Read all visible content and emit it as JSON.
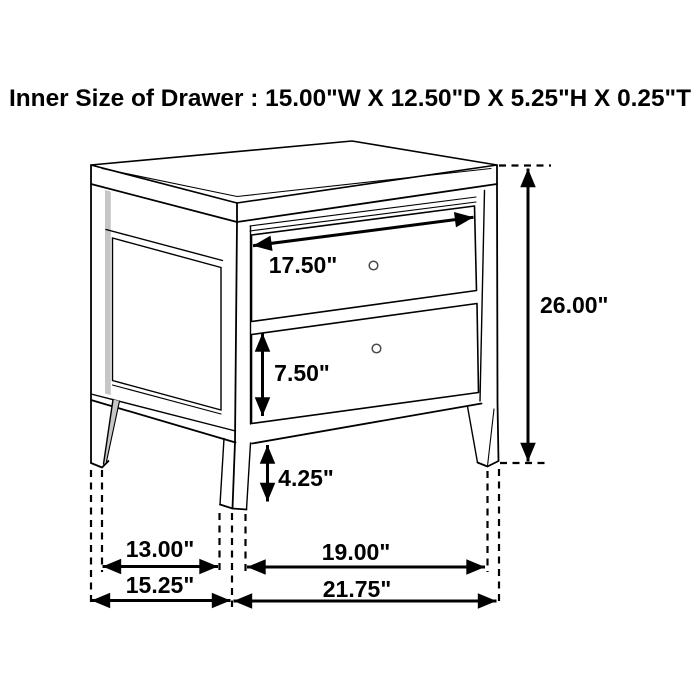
{
  "title": "Inner Size of Drawer : 15.00\"W X 12.50\"D X 5.25\"H X 0.25\"T",
  "diagram": {
    "type": "furniture-dimension-drawing",
    "subject": "2-drawer nightstand line drawing with dimension arrows",
    "labels": {
      "drawer_width": "17.50\"",
      "overall_height": "26.00\"",
      "drawer_front_height": "7.50\"",
      "floor_clearance": "4.25\"",
      "side_leg_spacing": "13.00\"",
      "overall_depth": "15.25\"",
      "front_leg_spacing": "19.00\"",
      "overall_width": "21.75\""
    },
    "colors": {
      "line": "#000000",
      "background": "#ffffff",
      "shading": "#c6c6c6"
    }
  }
}
